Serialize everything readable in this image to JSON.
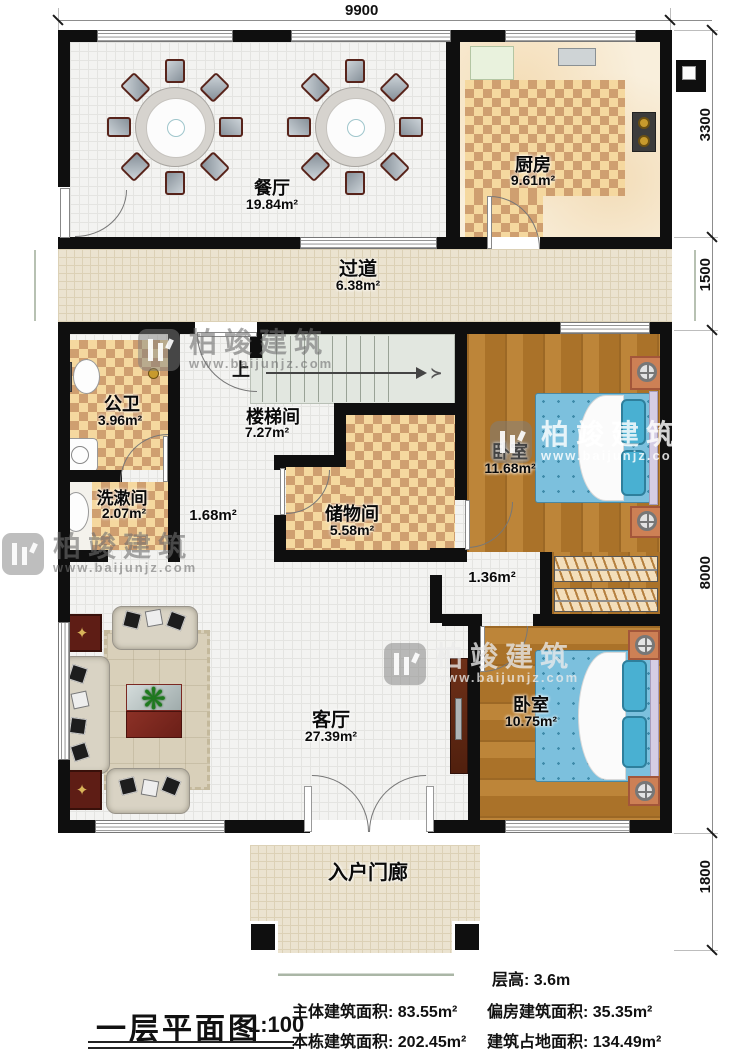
{
  "plan": {
    "dim_top": "9900",
    "dims_right": [
      "3300",
      "1500",
      "8000",
      "1800"
    ],
    "stair_up": "上",
    "rooms": {
      "dining": {
        "name": "餐厅",
        "area": "19.84m²"
      },
      "kitchen": {
        "name": "厨房",
        "area": "9.61m²"
      },
      "corridor": {
        "name": "过道",
        "area": "6.38m²"
      },
      "bathroom": {
        "name": "公卫",
        "area": "3.96m²"
      },
      "stairwell": {
        "name": "楼梯间",
        "area": "7.27m²"
      },
      "washroom": {
        "name": "洗漱间",
        "area": "2.07m²"
      },
      "hall_small": {
        "area": "1.68m²"
      },
      "storage": {
        "name": "储物间",
        "area": "5.58m²"
      },
      "bedroom_top": {
        "name": "卧室",
        "area": "11.68m²"
      },
      "hall_mid": {
        "area": "1.36m²"
      },
      "living": {
        "name": "客厅",
        "area": "27.39m²"
      },
      "bedroom_bottom": {
        "name": "卧室",
        "area": "10.75m²"
      },
      "porch": {
        "name": "入户门廊"
      }
    }
  },
  "footer": {
    "title": "一层平面图",
    "scale": "1:100",
    "floor_height": "层高: 3.6m",
    "stats": [
      "主体建筑面积: 83.55m²",
      "偏房建筑面积: 35.35m²",
      "本栋建筑面积: 202.45m²",
      "建筑占地面积: 134.49m²"
    ]
  },
  "watermark": {
    "name": "柏竣建筑",
    "url": "www.baijunjz.com"
  },
  "colors": {
    "wall": "#0f0f0f",
    "checker_tile": "#cf9f70",
    "wood_floor": "#b3793a",
    "bed_blue": "#7cc0dd",
    "steps_green": "#dde4d8"
  }
}
